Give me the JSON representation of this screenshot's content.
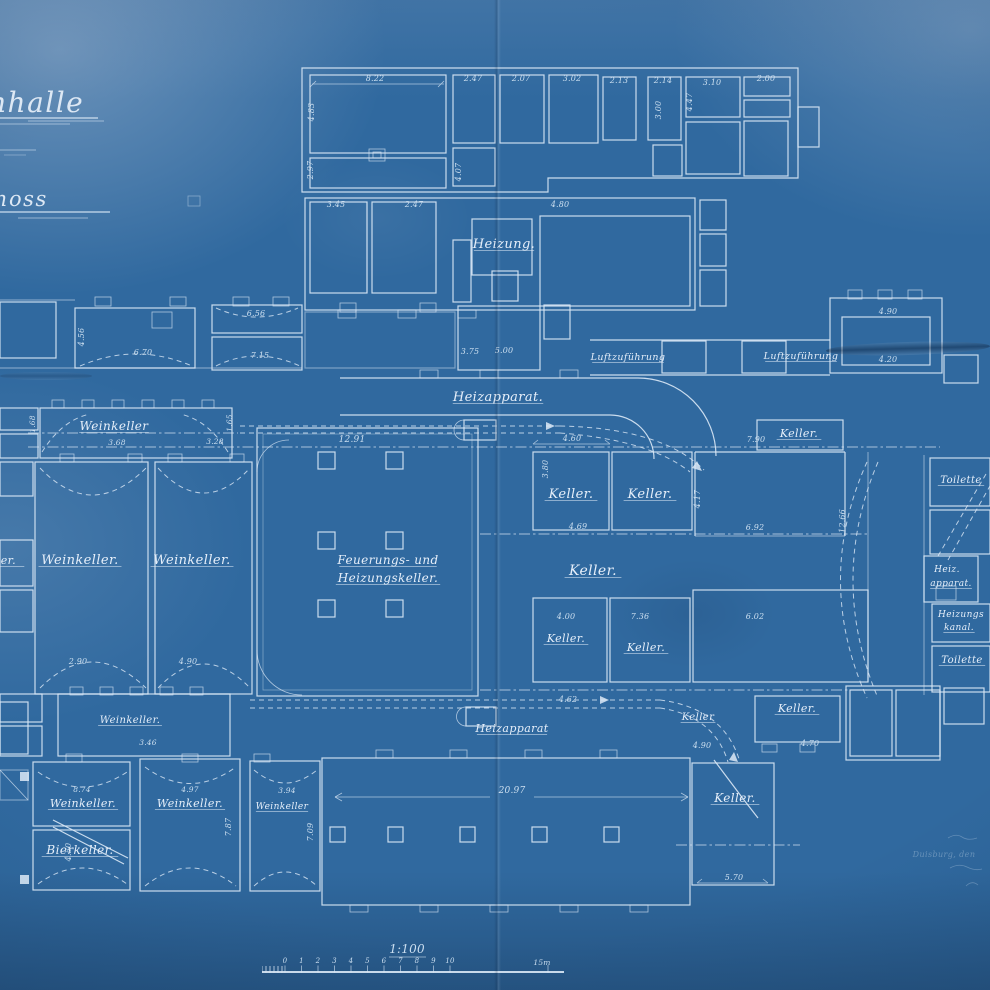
{
  "title": {
    "fragment1": "nhalle",
    "fragment2": "hoss"
  },
  "scale": {
    "ratio_label": "1:100",
    "tick_labels": [
      "0",
      "1",
      "2",
      "3",
      "4",
      "5",
      "6",
      "7",
      "8",
      "9",
      "10"
    ],
    "end_label": "15m"
  },
  "signature": {
    "city_date_line": "Duisburg, den"
  },
  "colors": {
    "paper_blue": "#30699f",
    "line_white": "#dce9f6"
  },
  "labels": [
    {
      "t": "Heizung.",
      "x": 504,
      "y": 248,
      "s": 13,
      "c": "script",
      "u": true
    },
    {
      "t": "Heizapparat.",
      "x": 498,
      "y": 401,
      "s": 13,
      "c": "script",
      "u": true
    },
    {
      "t": "Luftzuführung",
      "x": 628,
      "y": 360,
      "s": 9.5,
      "c": "script",
      "u": true
    },
    {
      "t": "Luftzuführung",
      "x": 801,
      "y": 359,
      "s": 9.5,
      "c": "script",
      "u": true
    },
    {
      "t": "Weinkeller",
      "x": 114,
      "y": 430,
      "s": 12,
      "c": "script",
      "u": true
    },
    {
      "t": "Weinkeller.",
      "x": 80,
      "y": 564,
      "s": 13,
      "c": "script",
      "u": true
    },
    {
      "t": "Weinkeller.",
      "x": 192,
      "y": 564,
      "s": 13,
      "c": "script",
      "u": true
    },
    {
      "t": "eller.",
      "x": -14,
      "y": 564,
      "s": 11,
      "c": "script",
      "a": "start",
      "u": true
    },
    {
      "t": "Feuerungs- und",
      "x": 388,
      "y": 564,
      "s": 12,
      "c": "script",
      "u": true
    },
    {
      "t": "Heizungskeller.",
      "x": 388,
      "y": 582,
      "s": 12,
      "c": "script",
      "u": true
    },
    {
      "t": "Keller.",
      "x": 571,
      "y": 498,
      "s": 13,
      "c": "script",
      "u": true
    },
    {
      "t": "Keller.",
      "x": 650,
      "y": 498,
      "s": 13,
      "c": "script",
      "u": true
    },
    {
      "t": "Keller.",
      "x": 593,
      "y": 575,
      "s": 14,
      "c": "script",
      "u": true
    },
    {
      "t": "Keller.",
      "x": 799,
      "y": 437,
      "s": 11,
      "c": "script",
      "u": true
    },
    {
      "t": "Keller.",
      "x": 566,
      "y": 642,
      "s": 11,
      "c": "script",
      "u": true
    },
    {
      "t": "Keller.",
      "x": 646,
      "y": 651,
      "s": 11,
      "c": "script",
      "u": true
    },
    {
      "t": "Keller",
      "x": 698,
      "y": 720,
      "s": 10,
      "c": "script",
      "u": true
    },
    {
      "t": "Keller.",
      "x": 797,
      "y": 712,
      "s": 11,
      "c": "script",
      "u": true
    },
    {
      "t": "Keller.",
      "x": 735,
      "y": 802,
      "s": 12,
      "c": "script",
      "u": true
    },
    {
      "t": "Weinkeller.",
      "x": 130,
      "y": 723,
      "s": 10,
      "c": "script",
      "u": true
    },
    {
      "t": "Weinkeller.",
      "x": 83,
      "y": 807,
      "s": 11,
      "c": "script",
      "u": true
    },
    {
      "t": "Weinkeller.",
      "x": 190,
      "y": 807,
      "s": 11,
      "c": "script",
      "u": true
    },
    {
      "t": "Weinkeller",
      "x": 282,
      "y": 809,
      "s": 9,
      "c": "script",
      "u": true
    },
    {
      "t": "Bierkeller.",
      "x": 80,
      "y": 854,
      "s": 12,
      "c": "script",
      "u": true
    },
    {
      "t": "Toilette",
      "x": 961,
      "y": 483,
      "s": 10,
      "c": "script",
      "u": true
    },
    {
      "t": "Heiz.",
      "x": 947,
      "y": 572,
      "s": 9,
      "c": "script"
    },
    {
      "t": "apparat.",
      "x": 951,
      "y": 586,
      "s": 9,
      "c": "script",
      "u": true
    },
    {
      "t": "Heizungs",
      "x": 961,
      "y": 617,
      "s": 9,
      "c": "script"
    },
    {
      "t": "kanal.",
      "x": 959,
      "y": 630,
      "s": 9,
      "c": "script",
      "u": true
    },
    {
      "t": "Toilette",
      "x": 962,
      "y": 663,
      "s": 10,
      "c": "script",
      "u": true
    },
    {
      "t": "Heizapparat",
      "x": 512,
      "y": 732,
      "s": 11,
      "c": "script",
      "u": true
    },
    {
      "t": "8.22",
      "x": 375,
      "y": 81,
      "s": 8,
      "c": "dim"
    },
    {
      "t": "2.47",
      "x": 473,
      "y": 81,
      "s": 8,
      "c": "dim"
    },
    {
      "t": "2.07",
      "x": 521,
      "y": 81,
      "s": 8,
      "c": "dim"
    },
    {
      "t": "3.02",
      "x": 572,
      "y": 81,
      "s": 8,
      "c": "dim"
    },
    {
      "t": "2.13",
      "x": 619,
      "y": 83,
      "s": 8,
      "c": "dim"
    },
    {
      "t": "2.14",
      "x": 663,
      "y": 83,
      "s": 8,
      "c": "dim"
    },
    {
      "t": "3.10",
      "x": 712,
      "y": 85,
      "s": 8,
      "c": "dim"
    },
    {
      "t": "2.00",
      "x": 766,
      "y": 81,
      "s": 8,
      "c": "dim"
    },
    {
      "t": "4.83",
      "x": 314,
      "y": 112,
      "s": 8,
      "c": "dim",
      "r": -90
    },
    {
      "t": "2.97",
      "x": 313,
      "y": 170,
      "s": 8,
      "c": "dim",
      "r": -90
    },
    {
      "t": "4.07",
      "x": 461,
      "y": 172,
      "s": 8,
      "c": "dim",
      "r": -90
    },
    {
      "t": "3.00",
      "x": 661,
      "y": 110,
      "s": 8,
      "c": "dim",
      "r": -90
    },
    {
      "t": "4.47",
      "x": 692,
      "y": 102,
      "s": 8,
      "c": "dim",
      "r": -90
    },
    {
      "t": "3.45",
      "x": 336,
      "y": 207,
      "s": 8,
      "c": "dim"
    },
    {
      "t": "2.47",
      "x": 414,
      "y": 207,
      "s": 8,
      "c": "dim"
    },
    {
      "t": "4.80",
      "x": 560,
      "y": 207,
      "s": 8,
      "c": "dim"
    },
    {
      "t": "6.70",
      "x": 143,
      "y": 355,
      "s": 8,
      "c": "dim"
    },
    {
      "t": "7.15",
      "x": 260,
      "y": 358,
      "s": 8,
      "c": "dim"
    },
    {
      "t": "6.56",
      "x": 256,
      "y": 316,
      "s": 8,
      "c": "dim"
    },
    {
      "t": "3.75",
      "x": 470,
      "y": 354,
      "s": 8,
      "c": "dim"
    },
    {
      "t": "5.00",
      "x": 504,
      "y": 353,
      "s": 8,
      "c": "dim"
    },
    {
      "t": "4.90",
      "x": 888,
      "y": 314,
      "s": 8,
      "c": "dim"
    },
    {
      "t": "4.20",
      "x": 888,
      "y": 362,
      "s": 8,
      "c": "dim"
    },
    {
      "t": "12.91",
      "x": 352,
      "y": 442,
      "s": 9,
      "c": "dim"
    },
    {
      "t": "4.60",
      "x": 572,
      "y": 441,
      "s": 8,
      "c": "dim"
    },
    {
      "t": "7.90",
      "x": 756,
      "y": 442,
      "s": 8,
      "c": "dim"
    },
    {
      "t": "4.69",
      "x": 578,
      "y": 529,
      "s": 8,
      "c": "dim"
    },
    {
      "t": "6.92",
      "x": 755,
      "y": 530,
      "s": 8,
      "c": "dim"
    },
    {
      "t": "4.17",
      "x": 700,
      "y": 499,
      "s": 8,
      "c": "dim",
      "r": -90
    },
    {
      "t": "3.80",
      "x": 548,
      "y": 469,
      "s": 8,
      "c": "dim",
      "r": -90
    },
    {
      "t": "4.00",
      "x": 566,
      "y": 619,
      "s": 8,
      "c": "dim"
    },
    {
      "t": "7.36",
      "x": 640,
      "y": 619,
      "s": 8,
      "c": "dim"
    },
    {
      "t": "6.02",
      "x": 755,
      "y": 619,
      "s": 8,
      "c": "dim"
    },
    {
      "t": "4.62",
      "x": 568,
      "y": 702,
      "s": 8,
      "c": "dim"
    },
    {
      "t": "4.90",
      "x": 702,
      "y": 748,
      "s": 8,
      "c": "dim"
    },
    {
      "t": "4.70",
      "x": 810,
      "y": 746,
      "s": 8,
      "c": "dim"
    },
    {
      "t": "20.97",
      "x": 512,
      "y": 793,
      "s": 9,
      "c": "dim"
    },
    {
      "t": "5.70",
      "x": 734,
      "y": 880,
      "s": 8,
      "c": "dim"
    },
    {
      "t": "3.68",
      "x": 117,
      "y": 445,
      "s": 7.5,
      "c": "dim"
    },
    {
      "t": "3.28",
      "x": 215,
      "y": 444,
      "s": 7.5,
      "c": "dim"
    },
    {
      "t": "1.68",
      "x": 35,
      "y": 424,
      "s": 7.5,
      "c": "dim",
      "r": -90
    },
    {
      "t": "1.65",
      "x": 232,
      "y": 423,
      "s": 7.5,
      "c": "dim",
      "r": -90
    },
    {
      "t": "2.90",
      "x": 78,
      "y": 664,
      "s": 8,
      "c": "dim"
    },
    {
      "t": "4.90",
      "x": 188,
      "y": 664,
      "s": 8,
      "c": "dim"
    },
    {
      "t": "7.87",
      "x": 231,
      "y": 827,
      "s": 8,
      "c": "dim",
      "r": -90
    },
    {
      "t": "7.09",
      "x": 313,
      "y": 832,
      "s": 8,
      "c": "dim",
      "r": -90
    },
    {
      "t": "4.50",
      "x": 71,
      "y": 852,
      "s": 8,
      "c": "dim",
      "r": -90
    },
    {
      "t": "8.74",
      "x": 82,
      "y": 792,
      "s": 7.5,
      "c": "dim"
    },
    {
      "t": "4.97",
      "x": 190,
      "y": 792,
      "s": 7.5,
      "c": "dim"
    },
    {
      "t": "3.94",
      "x": 287,
      "y": 793,
      "s": 7.5,
      "c": "dim"
    },
    {
      "t": "3.46",
      "x": 148,
      "y": 745,
      "s": 7.5,
      "c": "dim"
    },
    {
      "t": "12.66",
      "x": 845,
      "y": 521,
      "s": 8,
      "c": "dim",
      "r": -90
    },
    {
      "t": "4.56",
      "x": 84,
      "y": 337,
      "s": 8,
      "c": "dim",
      "r": -90
    }
  ]
}
